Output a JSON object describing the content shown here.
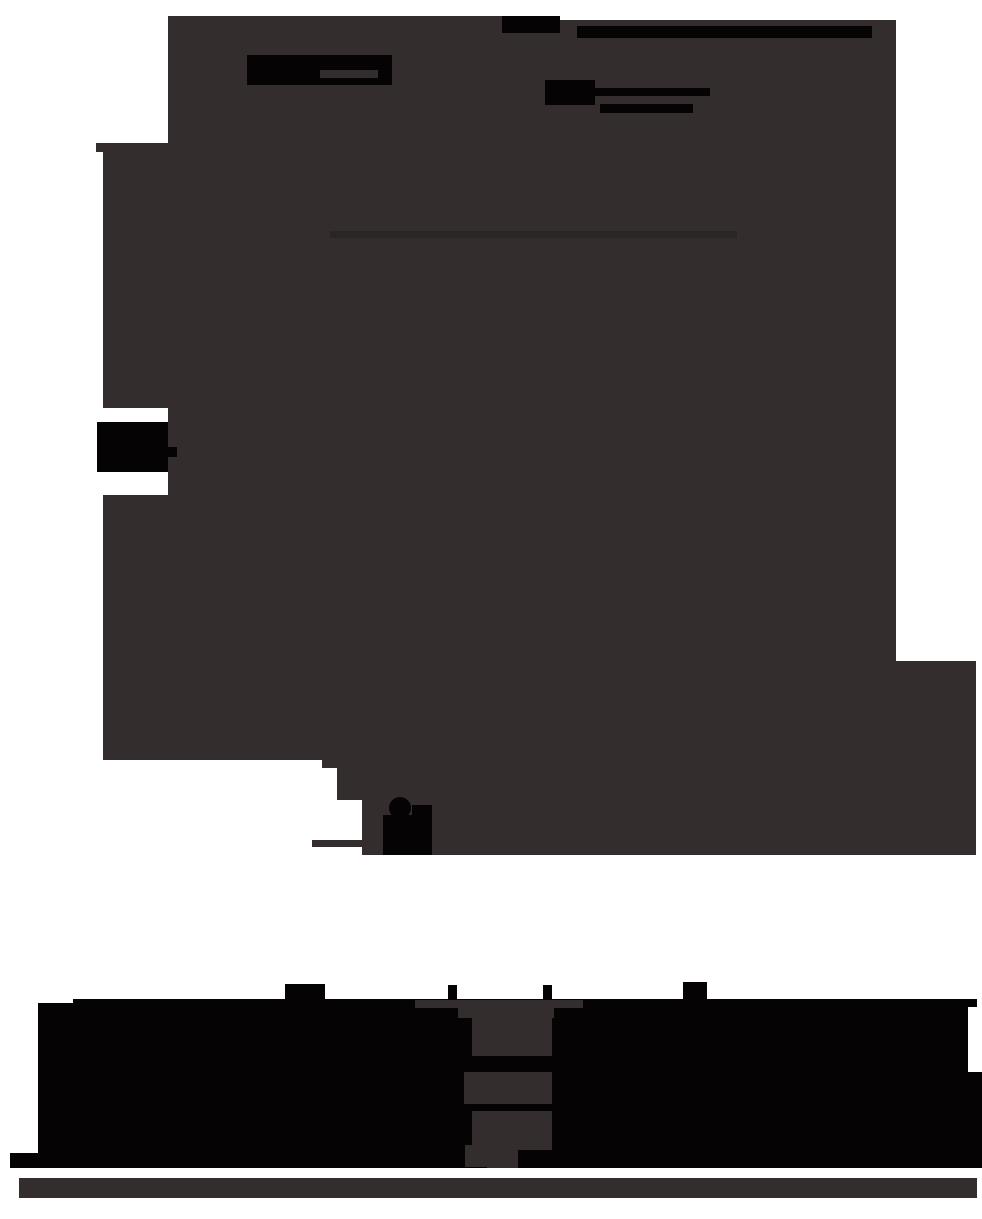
{
  "meta": {
    "description": "Flattened silhouette screenshot: no legible text is rendered. A large dark panel covers most of the page with solid black redaction-style bars near the top, a small black tab on the left edge, a black pointer blob near the panel's lower edge, a huge black wordmark band near the bottom with a dark funnel-shaped knockout, and a thin dark footer bar.",
    "canvas": {
      "width": 982,
      "height": 1219
    }
  },
  "palette": {
    "background": "#ffffff",
    "surface": "#332d2d",
    "surface_faint": "#2b2626",
    "ink": "#050303"
  },
  "regions": [
    {
      "name": "main-panel",
      "role": "large dark content surface"
    },
    {
      "name": "top-left-redacted-block",
      "role": "solid black block at panel top"
    },
    {
      "name": "top-redacted-bar",
      "role": "long black bar across panel top"
    },
    {
      "name": "heading-redacted-block",
      "role": "black heading block with slit"
    },
    {
      "name": "subheading-redacted-square",
      "role": "black square"
    },
    {
      "name": "subheading-redacted-line-1",
      "role": "black line"
    },
    {
      "name": "subheading-redacted-line-2",
      "role": "black line"
    },
    {
      "name": "faint-divider-line",
      "role": "slightly darker strip inside panel"
    },
    {
      "name": "left-edge-tab",
      "role": "black tab protruding from left edge"
    },
    {
      "name": "pointer-blob",
      "role": "black cursor-like blob at panel bottom edge"
    },
    {
      "name": "staircase-step",
      "role": "small dark step at panel bottom-left"
    },
    {
      "name": "wordmark-band",
      "role": "giant black wordmark mass"
    },
    {
      "name": "wordmark-funnel",
      "role": "dark segmented funnel knockout inside wordmark"
    },
    {
      "name": "footer-bar",
      "role": "thin dark bar under wordmark"
    }
  ]
}
